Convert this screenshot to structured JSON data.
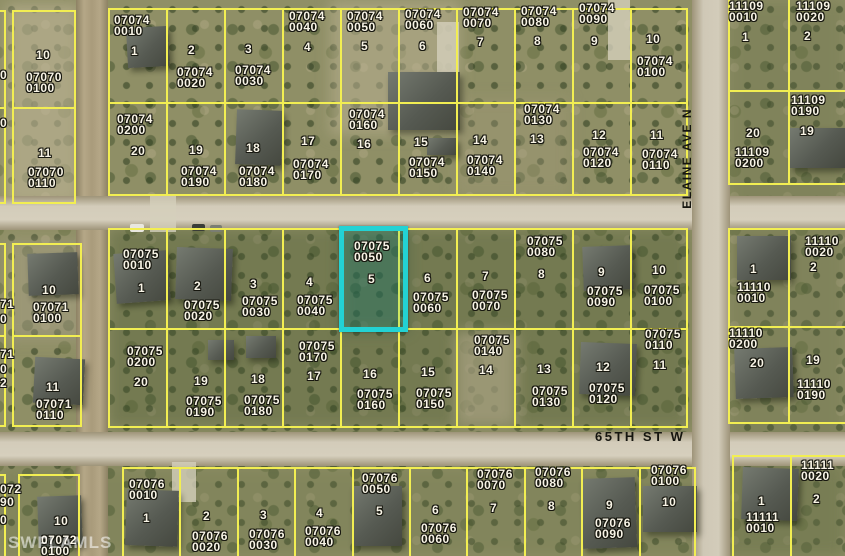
{
  "map": {
    "colors": {
      "parcel_line": "#f2ee52",
      "highlight": "#23d2d4",
      "label_text": "#f8f4e6",
      "street_text": "#15150f",
      "watermark": "rgba(255,255,255,0.55)"
    },
    "watermark": "SWFLAMLS",
    "streets": {
      "horizontal": {
        "name": "65TH ST W"
      },
      "vertical": {
        "name": "ELAINE AVE N"
      }
    },
    "highlighted_parcel": {
      "id": "07075 0050",
      "lot": "5",
      "x": 339,
      "y": 226,
      "w": 69,
      "h": 106
    },
    "blocks": [
      {
        "x": 12,
        "y": 10,
        "w": 64,
        "h": 194,
        "rows": 2,
        "cols": 1
      },
      {
        "x": 108,
        "y": 8,
        "w": 580,
        "h": 188,
        "rows": 2,
        "cols": 10
      },
      {
        "x": 728,
        "y": -6,
        "w": 120,
        "h": 191,
        "rows": 2,
        "cols": 2
      },
      {
        "x": 12,
        "y": 243,
        "w": 70,
        "h": 184,
        "rows": 2,
        "cols": 1
      },
      {
        "x": 108,
        "y": 228,
        "w": 580,
        "h": 200,
        "rows": 2,
        "cols": 10
      },
      {
        "x": 728,
        "y": 228,
        "w": 120,
        "h": 196,
        "rows": 2,
        "cols": 2
      },
      {
        "x": 18,
        "y": 474,
        "w": 62,
        "h": 86,
        "rows": 1,
        "cols": 1
      },
      {
        "x": 122,
        "y": 467,
        "w": 574,
        "h": 93,
        "rows": 1,
        "cols": 10
      },
      {
        "x": 732,
        "y": 455,
        "w": 116,
        "h": 105,
        "rows": 1,
        "cols": 2
      },
      {
        "x": -40,
        "y": 10,
        "w": 46,
        "h": 194,
        "rows": 2,
        "cols": 1
      },
      {
        "x": -40,
        "y": 243,
        "w": 46,
        "h": 184,
        "rows": 2,
        "cols": 1
      },
      {
        "x": -40,
        "y": 474,
        "w": 46,
        "h": 86,
        "rows": 1,
        "cols": 1
      }
    ],
    "labels": [
      {
        "b": "07070",
        "l": "0100",
        "x": 26,
        "y": 72
      },
      {
        "b": "07070",
        "l": "0110",
        "x": 28,
        "y": 167
      },
      {
        "b": "07074",
        "l": "0010",
        "x": 114,
        "y": 15
      },
      {
        "b": "07074",
        "l": "0020",
        "x": 177,
        "y": 67
      },
      {
        "b": "07074",
        "l": "0030",
        "x": 235,
        "y": 65
      },
      {
        "b": "07074",
        "l": "0040",
        "x": 289,
        "y": 11
      },
      {
        "b": "07074",
        "l": "0050",
        "x": 347,
        "y": 11
      },
      {
        "b": "07074",
        "l": "0060",
        "x": 405,
        "y": 9
      },
      {
        "b": "07074",
        "l": "0070",
        "x": 463,
        "y": 7
      },
      {
        "b": "07074",
        "l": "0080",
        "x": 521,
        "y": 6
      },
      {
        "b": "07074",
        "l": "0090",
        "x": 579,
        "y": 3
      },
      {
        "b": "07074",
        "l": "0100",
        "x": 637,
        "y": 56
      },
      {
        "b": "07074",
        "l": "0200",
        "x": 117,
        "y": 114
      },
      {
        "b": "07074",
        "l": "0190",
        "x": 181,
        "y": 166
      },
      {
        "b": "07074",
        "l": "0180",
        "x": 239,
        "y": 166
      },
      {
        "b": "07074",
        "l": "0170",
        "x": 293,
        "y": 159
      },
      {
        "b": "07074",
        "l": "0160",
        "x": 349,
        "y": 109
      },
      {
        "b": "07074",
        "l": "0150",
        "x": 409,
        "y": 157
      },
      {
        "b": "07074",
        "l": "0140",
        "x": 467,
        "y": 155
      },
      {
        "b": "07074",
        "l": "0130",
        "x": 524,
        "y": 104
      },
      {
        "b": "07074",
        "l": "0120",
        "x": 583,
        "y": 147
      },
      {
        "b": "07074",
        "l": "0110",
        "x": 642,
        "y": 149
      },
      {
        "b": "11109",
        "l": "0010",
        "x": 729,
        "y": 1
      },
      {
        "b": "11109",
        "l": "0020",
        "x": 796,
        "y": 1
      },
      {
        "b": "11109",
        "l": "0200",
        "x": 735,
        "y": 147
      },
      {
        "b": "11109",
        "l": "0190",
        "x": 791,
        "y": 95
      },
      {
        "b": "07071",
        "l": "0100",
        "x": 33,
        "y": 302
      },
      {
        "b": "07071",
        "l": "0110",
        "x": 36,
        "y": 399
      },
      {
        "b": "07075",
        "l": "0010",
        "x": 123,
        "y": 249
      },
      {
        "b": "07075",
        "l": "0020",
        "x": 184,
        "y": 300
      },
      {
        "b": "07075",
        "l": "0030",
        "x": 242,
        "y": 296
      },
      {
        "b": "07075",
        "l": "0040",
        "x": 297,
        "y": 295
      },
      {
        "b": "07075",
        "l": "0050",
        "x": 354,
        "y": 241
      },
      {
        "b": "07075",
        "l": "0060",
        "x": 413,
        "y": 292
      },
      {
        "b": "07075",
        "l": "0070",
        "x": 472,
        "y": 290
      },
      {
        "b": "07075",
        "l": "0080",
        "x": 527,
        "y": 236
      },
      {
        "b": "07075",
        "l": "0090",
        "x": 587,
        "y": 286
      },
      {
        "b": "07075",
        "l": "0100",
        "x": 644,
        "y": 285
      },
      {
        "b": "07075",
        "l": "0200",
        "x": 127,
        "y": 346
      },
      {
        "b": "07075",
        "l": "0190",
        "x": 186,
        "y": 396
      },
      {
        "b": "07075",
        "l": "0180",
        "x": 244,
        "y": 395
      },
      {
        "b": "07075",
        "l": "0170",
        "x": 299,
        "y": 341
      },
      {
        "b": "07075",
        "l": "0160",
        "x": 357,
        "y": 389
      },
      {
        "b": "07075",
        "l": "0150",
        "x": 416,
        "y": 388
      },
      {
        "b": "07075",
        "l": "0140",
        "x": 474,
        "y": 335
      },
      {
        "b": "07075",
        "l": "0130",
        "x": 532,
        "y": 386
      },
      {
        "b": "07075",
        "l": "0120",
        "x": 589,
        "y": 383
      },
      {
        "b": "07075",
        "l": "0110",
        "x": 645,
        "y": 329
      },
      {
        "b": "11110",
        "l": "0010",
        "x": 737,
        "y": 282
      },
      {
        "b": "11110",
        "l": "0020",
        "x": 805,
        "y": 236
      },
      {
        "b": "11110",
        "l": "0200",
        "x": 729,
        "y": 328
      },
      {
        "b": "11110",
        "l": "0190",
        "x": 797,
        "y": 379
      },
      {
        "b": "07072",
        "l": "0100",
        "x": 41,
        "y": 535
      },
      {
        "b": "07076",
        "l": "0010",
        "x": 129,
        "y": 479
      },
      {
        "b": "07076",
        "l": "0020",
        "x": 192,
        "y": 531
      },
      {
        "b": "07076",
        "l": "0030",
        "x": 249,
        "y": 529
      },
      {
        "b": "07076",
        "l": "0040",
        "x": 305,
        "y": 526
      },
      {
        "b": "07076",
        "l": "0050",
        "x": 362,
        "y": 473
      },
      {
        "b": "07076",
        "l": "0060",
        "x": 421,
        "y": 523
      },
      {
        "b": "07076",
        "l": "0070",
        "x": 477,
        "y": 469
      },
      {
        "b": "07076",
        "l": "0080",
        "x": 535,
        "y": 467
      },
      {
        "b": "07076",
        "l": "0090",
        "x": 595,
        "y": 518
      },
      {
        "b": "07076",
        "l": "0100",
        "x": 651,
        "y": 465
      },
      {
        "b": "11111",
        "l": "0010",
        "x": 746,
        "y": 512
      },
      {
        "b": "11111",
        "l": "0020",
        "x": 801,
        "y": 460
      }
    ],
    "lot_numbers": [
      {
        "n": "10",
        "x": 36,
        "y": 50
      },
      {
        "n": "11",
        "x": 38,
        "y": 148
      },
      {
        "n": "1",
        "x": 131,
        "y": 46
      },
      {
        "n": "2",
        "x": 188,
        "y": 45
      },
      {
        "n": "3",
        "x": 245,
        "y": 44
      },
      {
        "n": "4",
        "x": 304,
        "y": 42
      },
      {
        "n": "5",
        "x": 361,
        "y": 41
      },
      {
        "n": "6",
        "x": 419,
        "y": 41
      },
      {
        "n": "7",
        "x": 477,
        "y": 37
      },
      {
        "n": "8",
        "x": 534,
        "y": 36
      },
      {
        "n": "9",
        "x": 591,
        "y": 36
      },
      {
        "n": "10",
        "x": 646,
        "y": 34
      },
      {
        "n": "20",
        "x": 131,
        "y": 146
      },
      {
        "n": "19",
        "x": 189,
        "y": 145
      },
      {
        "n": "18",
        "x": 246,
        "y": 143
      },
      {
        "n": "17",
        "x": 301,
        "y": 136
      },
      {
        "n": "16",
        "x": 357,
        "y": 139
      },
      {
        "n": "15",
        "x": 414,
        "y": 137
      },
      {
        "n": "14",
        "x": 473,
        "y": 135
      },
      {
        "n": "13",
        "x": 530,
        "y": 134
      },
      {
        "n": "12",
        "x": 592,
        "y": 130
      },
      {
        "n": "11",
        "x": 650,
        "y": 130
      },
      {
        "n": "1",
        "x": 742,
        "y": 32
      },
      {
        "n": "2",
        "x": 804,
        "y": 31
      },
      {
        "n": "20",
        "x": 746,
        "y": 128
      },
      {
        "n": "19",
        "x": 800,
        "y": 126
      },
      {
        "n": "10",
        "x": 42,
        "y": 285
      },
      {
        "n": "11",
        "x": 46,
        "y": 382
      },
      {
        "n": "1",
        "x": 138,
        "y": 283
      },
      {
        "n": "2",
        "x": 194,
        "y": 281
      },
      {
        "n": "3",
        "x": 250,
        "y": 279
      },
      {
        "n": "4",
        "x": 306,
        "y": 277
      },
      {
        "n": "5",
        "x": 368,
        "y": 274
      },
      {
        "n": "6",
        "x": 424,
        "y": 273
      },
      {
        "n": "7",
        "x": 482,
        "y": 271
      },
      {
        "n": "8",
        "x": 538,
        "y": 269
      },
      {
        "n": "9",
        "x": 598,
        "y": 267
      },
      {
        "n": "10",
        "x": 652,
        "y": 265
      },
      {
        "n": "20",
        "x": 134,
        "y": 377
      },
      {
        "n": "19",
        "x": 194,
        "y": 376
      },
      {
        "n": "18",
        "x": 251,
        "y": 374
      },
      {
        "n": "17",
        "x": 307,
        "y": 371
      },
      {
        "n": "16",
        "x": 363,
        "y": 369
      },
      {
        "n": "15",
        "x": 421,
        "y": 367
      },
      {
        "n": "14",
        "x": 479,
        "y": 365
      },
      {
        "n": "13",
        "x": 537,
        "y": 364
      },
      {
        "n": "12",
        "x": 596,
        "y": 362
      },
      {
        "n": "11",
        "x": 653,
        "y": 360
      },
      {
        "n": "1",
        "x": 750,
        "y": 264
      },
      {
        "n": "2",
        "x": 810,
        "y": 262
      },
      {
        "n": "20",
        "x": 750,
        "y": 358
      },
      {
        "n": "19",
        "x": 806,
        "y": 355
      },
      {
        "n": "10",
        "x": 54,
        "y": 516
      },
      {
        "n": "1",
        "x": 143,
        "y": 513
      },
      {
        "n": "2",
        "x": 203,
        "y": 511
      },
      {
        "n": "3",
        "x": 260,
        "y": 510
      },
      {
        "n": "4",
        "x": 316,
        "y": 508
      },
      {
        "n": "5",
        "x": 376,
        "y": 506
      },
      {
        "n": "6",
        "x": 432,
        "y": 505
      },
      {
        "n": "7",
        "x": 490,
        "y": 503
      },
      {
        "n": "8",
        "x": 548,
        "y": 501
      },
      {
        "n": "9",
        "x": 606,
        "y": 500
      },
      {
        "n": "10",
        "x": 662,
        "y": 497
      },
      {
        "n": "1",
        "x": 758,
        "y": 496
      },
      {
        "n": "2",
        "x": 813,
        "y": 494
      }
    ],
    "fragments": [
      {
        "t": "0",
        "x": 0,
        "y": 70
      },
      {
        "t": "0",
        "x": 0,
        "y": 118
      },
      {
        "t": "71",
        "x": 0,
        "y": 299
      },
      {
        "t": "0",
        "x": 0,
        "y": 314
      },
      {
        "t": "71",
        "x": 0,
        "y": 349
      },
      {
        "t": "0",
        "x": 0,
        "y": 364
      },
      {
        "t": "2",
        "x": 0,
        "y": 378
      },
      {
        "t": "072",
        "x": 0,
        "y": 484
      },
      {
        "t": "90",
        "x": 0,
        "y": 497
      },
      {
        "t": "0",
        "x": 0,
        "y": 515
      }
    ],
    "houses": [
      {
        "x": 127,
        "y": 27,
        "w": 42,
        "h": 40,
        "r": -3
      },
      {
        "x": 236,
        "y": 110,
        "w": 46,
        "h": 55,
        "r": 2
      },
      {
        "x": 388,
        "y": 72,
        "w": 72,
        "h": 58,
        "r": 0
      },
      {
        "x": 427,
        "y": 138,
        "w": 30,
        "h": 17,
        "r": 0
      },
      {
        "x": 790,
        "y": 128,
        "w": 55,
        "h": 40,
        "r": 0
      },
      {
        "x": 28,
        "y": 253,
        "w": 50,
        "h": 42,
        "r": -2
      },
      {
        "x": 34,
        "y": 358,
        "w": 50,
        "h": 46,
        "r": 3
      },
      {
        "x": 115,
        "y": 252,
        "w": 54,
        "h": 50,
        "r": -4
      },
      {
        "x": 176,
        "y": 248,
        "w": 56,
        "h": 52,
        "r": 2
      },
      {
        "x": 583,
        "y": 246,
        "w": 50,
        "h": 44,
        "r": -2
      },
      {
        "x": 580,
        "y": 343,
        "w": 56,
        "h": 52,
        "r": 2
      },
      {
        "x": 737,
        "y": 236,
        "w": 54,
        "h": 44,
        "r": 0
      },
      {
        "x": 735,
        "y": 348,
        "w": 58,
        "h": 50,
        "r": -2
      },
      {
        "x": 208,
        "y": 340,
        "w": 26,
        "h": 20,
        "r": 0
      },
      {
        "x": 246,
        "y": 336,
        "w": 30,
        "h": 22,
        "r": 0
      },
      {
        "x": 126,
        "y": 490,
        "w": 52,
        "h": 56,
        "r": 2
      },
      {
        "x": 352,
        "y": 486,
        "w": 50,
        "h": 60,
        "r": 0
      },
      {
        "x": 582,
        "y": 478,
        "w": 54,
        "h": 70,
        "r": -2
      },
      {
        "x": 643,
        "y": 486,
        "w": 54,
        "h": 46,
        "r": 0
      },
      {
        "x": 742,
        "y": 468,
        "w": 56,
        "h": 52,
        "r": 2
      },
      {
        "x": 38,
        "y": 496,
        "w": 44,
        "h": 50,
        "r": -2
      }
    ]
  }
}
